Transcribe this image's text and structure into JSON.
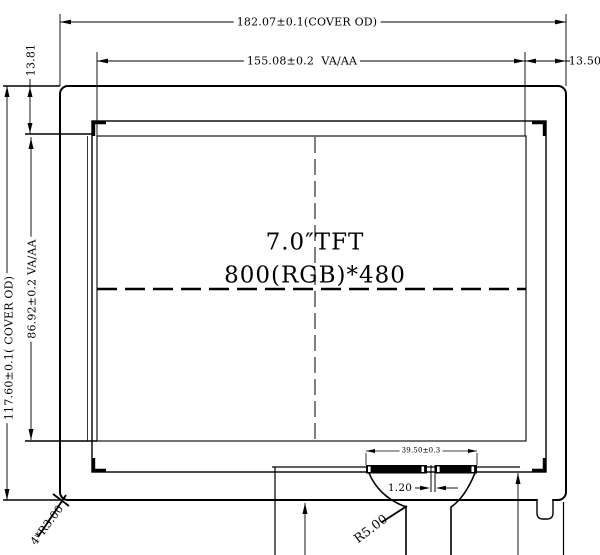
{
  "drawing": {
    "display": {
      "line1": "7.0″TFT",
      "line2": "800(RGB)*480"
    },
    "dimensions": {
      "cover_width": "182.07±0.1(COVER OD)",
      "aa_width": "155.08±0.2  VA/AA",
      "edge_right": "13.50",
      "edge_top": "13.81",
      "cover_height": "117.60±0.1( COVER OD)",
      "aa_height": "86.92±0.2 VA/AA",
      "fpc_pad_width": "39.50±0.3",
      "pad_gap": "1.20",
      "fpc_fillet_radius": "R5.00",
      "cover_corner_radius": "4*R3.00"
    },
    "colors": {
      "line": "#000000",
      "background": "#ffffff"
    }
  }
}
